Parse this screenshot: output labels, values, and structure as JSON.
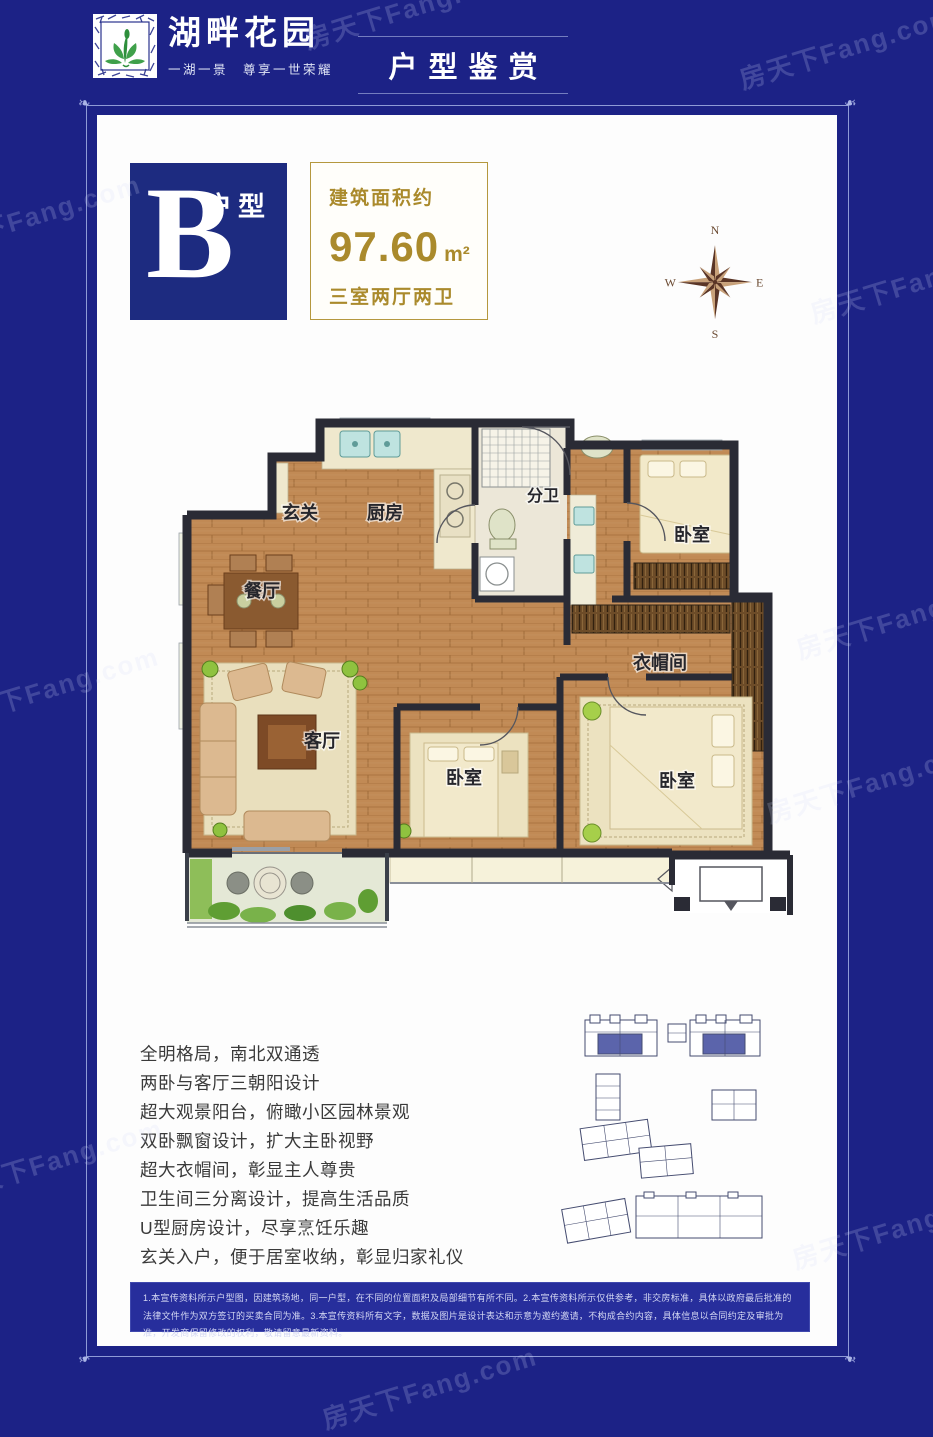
{
  "page": {
    "watermark": "房天下Fang.com",
    "background_color": "#1c2286"
  },
  "header": {
    "logo_icon": "lotus-sprout-icon",
    "brand_name": "湖畔花园",
    "brand_tagline": "一湖一景　尊享一世荣耀",
    "section_title": "户型鉴赏"
  },
  "card": {
    "unit_badge": {
      "letter": "B",
      "label": "户型"
    },
    "area_box": {
      "caption": "建筑面积约",
      "value": "97.60",
      "unit": "m²",
      "layout": "三室两厅两卫"
    },
    "compass": {
      "north": "N",
      "east": "E",
      "south": "S",
      "west": "W"
    },
    "floorplan": {
      "rooms": [
        {
          "id": "entry",
          "label": "玄关"
        },
        {
          "id": "kitchen",
          "label": "厨房"
        },
        {
          "id": "bath",
          "label": "分卫"
        },
        {
          "id": "bedroom-north",
          "label": "卧室"
        },
        {
          "id": "dining",
          "label": "餐厅"
        },
        {
          "id": "cloakroom",
          "label": "衣帽间"
        },
        {
          "id": "living",
          "label": "客厅"
        },
        {
          "id": "bedroom-middle",
          "label": "卧室"
        },
        {
          "id": "bedroom-master",
          "label": "卧室"
        }
      ]
    },
    "features": [
      "全明格局，南北双通透",
      "两卧与客厅三朝阳设计",
      "超大观景阳台，俯瞰小区园林景观",
      "双卧飘窗设计，扩大主卧视野",
      "超大衣帽间，彰显主人尊贵",
      "卫生间三分离设计，提高生活品质",
      "U型厨房设计，尽享烹饪乐趣",
      "玄关入户，便于居室收纳，彰显归家礼仪"
    ],
    "disclaimer": "1.本宣传资料所示户型图，因建筑场地，同一户型，在不同的位置面积及局部细节有所不同。2.本宣传资料所示仅供参考，非交房标准，具体以政府最后批准的法律文件作为双方签订的买卖合同为准。3.本宣传资料所有文字，数据及图片是设计表达和示意为邀约邀请，不构成合约内容，具体信息以合同约定及审批为准，开发商保留修改的权利，敬请留意最新资料。"
  },
  "colors": {
    "navy_background": "#1c2286",
    "badge_blue": "#1d2b80",
    "gold": "#ab8b2b",
    "wall": "#2a2b35",
    "wood": "#c18a55",
    "minimap_highlight": "#5b64ab"
  }
}
